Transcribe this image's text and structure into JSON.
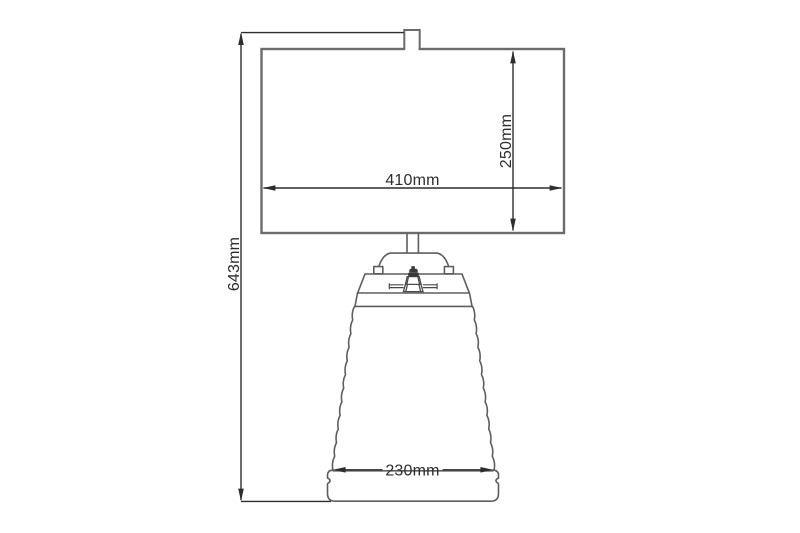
{
  "diagram": {
    "type": "technical-dimension-drawing",
    "subject": "Table lamp front elevation with dimension callouts",
    "labels": {
      "overall_height": "643mm",
      "shade_width": "410mm",
      "shade_height": "250mm",
      "base_width": "230mm"
    },
    "colors": {
      "background": "#ffffff",
      "shade_outline": "#6b6b6b",
      "lamp_outline": "#5e5e5e",
      "socket_fill": "#3a3a3a",
      "dimension_lines": "#2d2d2d",
      "label_text": "#2d2d2d"
    }
  }
}
